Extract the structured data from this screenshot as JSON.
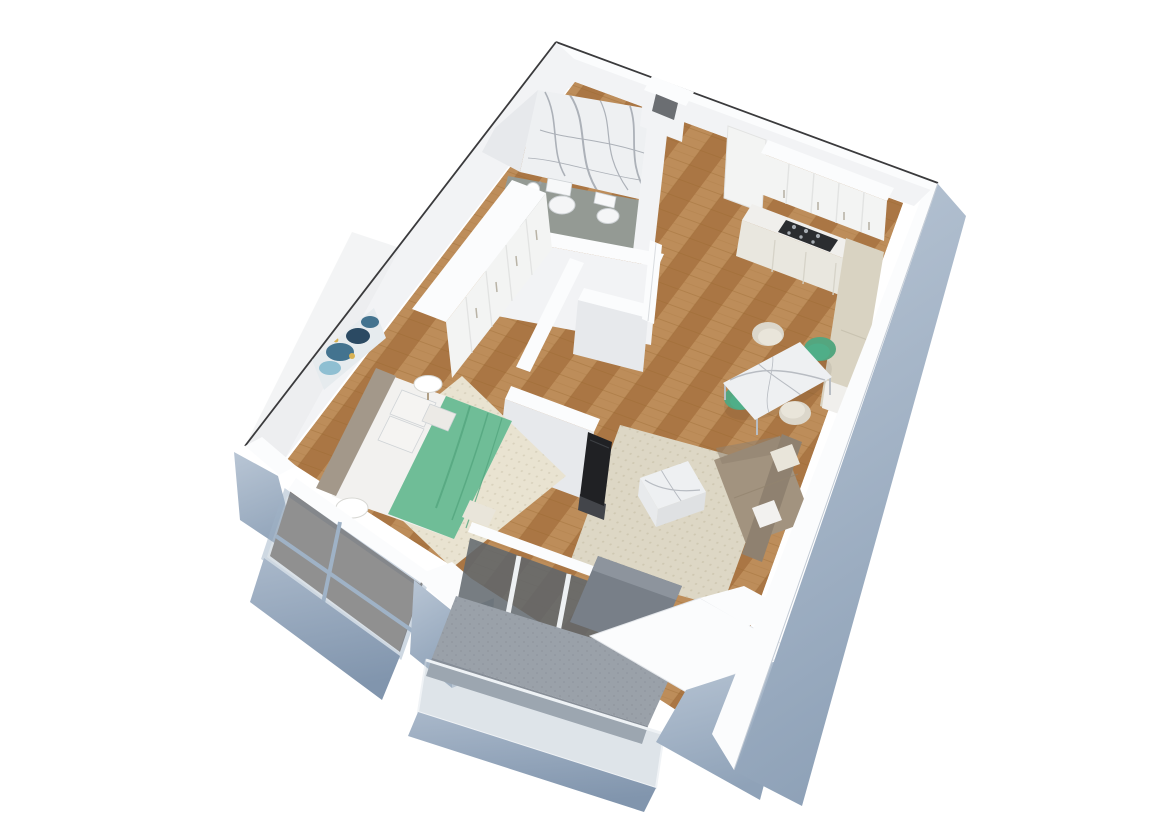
{
  "meta": {
    "title": "one-bedroom-apartment-3d-floor-plan",
    "description": "3D axonometric render of a one-bedroom apartment: bathroom with marble accent walls, hallway with wardrobe, kitchen with cooktop, dining area, living room with sofa and TV, bedroom with double bed, and balconies behind glass railings"
  },
  "scene": {
    "rooms": [
      {
        "id": "bathroom",
        "label": "Bathroom",
        "floor": "grey stone",
        "furniture": [
          "marble accent walls",
          "wall-hung toilet",
          "bidet",
          "washbasin"
        ]
      },
      {
        "id": "hallway",
        "label": "Hallway",
        "floor": "oak parquet",
        "furniture": [
          "built-in white wardrobe"
        ]
      },
      {
        "id": "kitchen",
        "label": "Kitchen",
        "floor": "oak parquet",
        "furniture": [
          "white upper cabinets",
          "tall cabinet",
          "base cabinets",
          "gas cooktop",
          "beige side counter"
        ]
      },
      {
        "id": "dining-area",
        "label": "Dining area",
        "floor": "oak parquet",
        "furniture": [
          "marble dining table",
          "2 cream chairs",
          "2 green chairs"
        ]
      },
      {
        "id": "living-room",
        "label": "Living room",
        "floor": "oak parquet",
        "furniture": [
          "beige rug",
          "taupe corner sofa",
          "marble cube coffee table",
          "flat-screen TV"
        ]
      },
      {
        "id": "bedroom",
        "label": "Bedroom",
        "floor": "oak parquet",
        "furniture": [
          "double bed with green throw",
          "taupe headboard",
          "2 round white nightstands",
          "abstract wall art",
          "beige rug"
        ]
      },
      {
        "id": "bedroom-balcony",
        "label": "Window bay",
        "floor": "dark parquet",
        "furniture": [
          "full-height glazing"
        ]
      },
      {
        "id": "balcony",
        "label": "Balcony",
        "floor": "concrete",
        "furniture": [
          "glass balustrade",
          "sliding glass door"
        ]
      },
      {
        "id": "terrace-corner",
        "label": "Terrace corner",
        "floor": "concrete",
        "furniture": [
          "parapet walls"
        ]
      }
    ],
    "exterior": "pale blue-grey facade walls with white parapet tops and a thin dark outline along the far walls"
  },
  "palette": {
    "outline": "#3a3a3c",
    "wallTop": "#fbfcfd",
    "wallFaceLight": "#f2f3f5",
    "wallFaceMid": "#e7e9ec",
    "wallFaceShadow": "#d9dce0",
    "extBlue": "#aab9ca",
    "extBlueLight": "#b9c6d5",
    "extBlueDark": "#8fa2b8",
    "frameBlue": "#9fb2c6",
    "glass": "#b7c4d0",
    "glassDark": "#5f666c",
    "woodBase": "#b5834f",
    "woodLight": "#bd8d5a",
    "woodMid": "#aa7644",
    "woodJoint": "#96662f",
    "woodFloorDark": "#6a5c50",
    "bathFloor": "#949a94",
    "concrete": "#9aa1a9",
    "concreteDark": "#878e97",
    "marble": "#eef0f2",
    "marbleVein": "#8187922",
    "vein": "#818792",
    "rugBed": "#e9e3d1",
    "rugLiving": "#ddd7c5",
    "rugDotBed": "#d9d2bd",
    "rugDotLiv": "#cfc8b2",
    "green": "#6fbd97",
    "greenDark": "#54a67f",
    "greenChair": "#4fae88",
    "cream": "#e9e5da",
    "taupe": "#a2937f",
    "taupeDark": "#8f8170",
    "headboard": "#a3988a",
    "bedWhite": "#f2f1ef",
    "shadowLine": "#cfd3d6",
    "tv": "#202124",
    "tvStand": "#43454a",
    "cooktop": "#2b2d30",
    "burner": "#a7adb3",
    "cabinet": "#f3f4f3",
    "cabinetSide": "#e2e3e2",
    "counterTop": "#f0efec",
    "counterBeige": "#d9d3c2",
    "baseCab": "#e9e7df",
    "metal": "#b9bec4",
    "artBase": "#e6ebee",
    "artBlue": "#43738f",
    "artDeep": "#2b4a63",
    "artLight": "#8fbfd2",
    "artGold": "#d9b254"
  }
}
